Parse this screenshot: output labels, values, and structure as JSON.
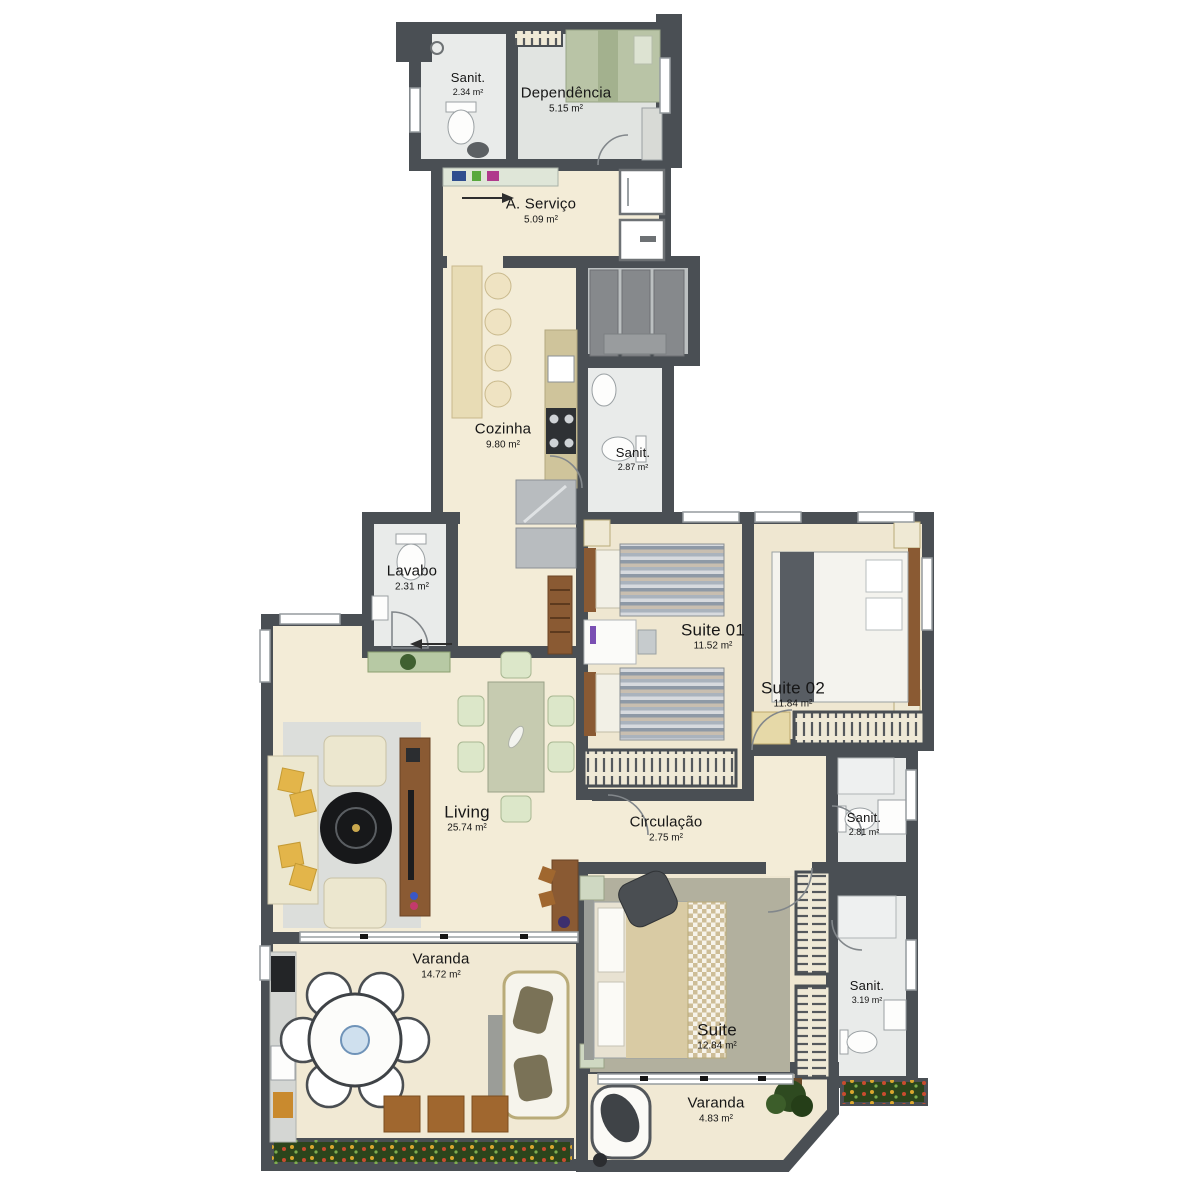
{
  "palette": {
    "wall": "#4a4f54",
    "floorCream": "#f3ecd7",
    "floorTile": "#e9ebea",
    "floorTileDark": "#e1e4e1",
    "floorBeige": "#efe7d1",
    "floorVaranda": "#f1e9d4",
    "closetGray": "#bcc0c1",
    "rugGray": "#dcdedb",
    "rugMaster": "#b2b09e",
    "wood": "#8a5a33",
    "planterGreen": "#2c451c",
    "pillowYellow": "#e3b54a",
    "chairGreen": "#dce7c9",
    "bedGreen": "#b9c4a6"
  },
  "rooms": [
    {
      "id": "sanit-dependencia",
      "label": "Sanit.",
      "area": "2.34 m²"
    },
    {
      "id": "dependencia",
      "label": "Dependência",
      "area": "5.15 m²"
    },
    {
      "id": "area-servico",
      "label": "A. Serviço",
      "area": "5.09 m²"
    },
    {
      "id": "cozinha",
      "label": "Cozinha",
      "area": "9.80 m²"
    },
    {
      "id": "sanit-cozinha",
      "label": "Sanit.",
      "area": "2.87 m²"
    },
    {
      "id": "lavabo",
      "label": "Lavabo",
      "area": "2.31 m²"
    },
    {
      "id": "suite-01",
      "label": "Suite 01",
      "area": "11.52 m²"
    },
    {
      "id": "suite-02",
      "label": "Suite 02",
      "area": "11.84 m²"
    },
    {
      "id": "living",
      "label": "Living",
      "area": "25.74 m²"
    },
    {
      "id": "circulacao",
      "label": "Circulação",
      "area": "2.75 m²"
    },
    {
      "id": "sanit-suite02",
      "label": "Sanit.",
      "area": "2.81 m²"
    },
    {
      "id": "varanda",
      "label": "Varanda",
      "area": "14.72 m²"
    },
    {
      "id": "sanit-suite",
      "label": "Sanit.",
      "area": "3.19 m²"
    },
    {
      "id": "suite-master",
      "label": "Suite",
      "area": "12.84 m²"
    },
    {
      "id": "varanda-suite",
      "label": "Varanda",
      "area": "4.83 m²"
    }
  ]
}
